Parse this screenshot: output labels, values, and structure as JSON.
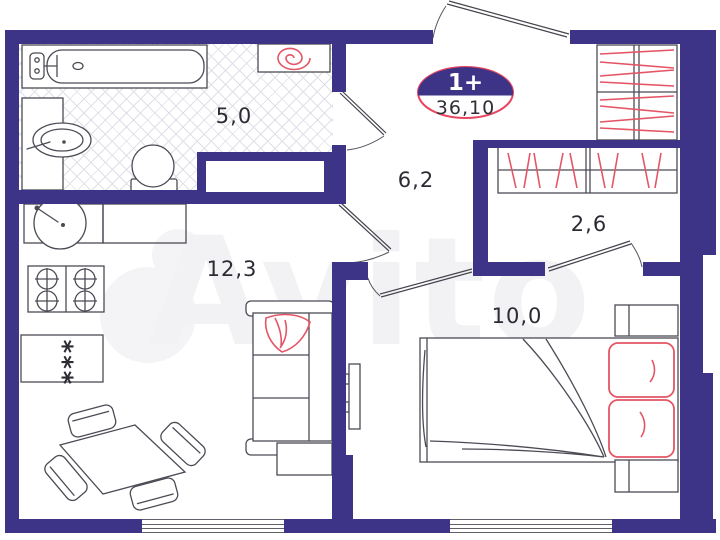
{
  "badge": {
    "rooms": "1+",
    "total_area": "36,10"
  },
  "rooms": {
    "bathroom": {
      "area": "5,0"
    },
    "hallway": {
      "area": "6,2"
    },
    "wardrobe_room": {
      "area": "2,6"
    },
    "kitchen_living": {
      "area": "12,3"
    },
    "bedroom": {
      "area": "10,0"
    }
  },
  "fridge_marking": "***",
  "watermark": "Avito",
  "colors": {
    "wall": "#3d3487",
    "accent_red": "#e45666",
    "badge_ring": "#e8435f",
    "line": "#4b4b55"
  }
}
